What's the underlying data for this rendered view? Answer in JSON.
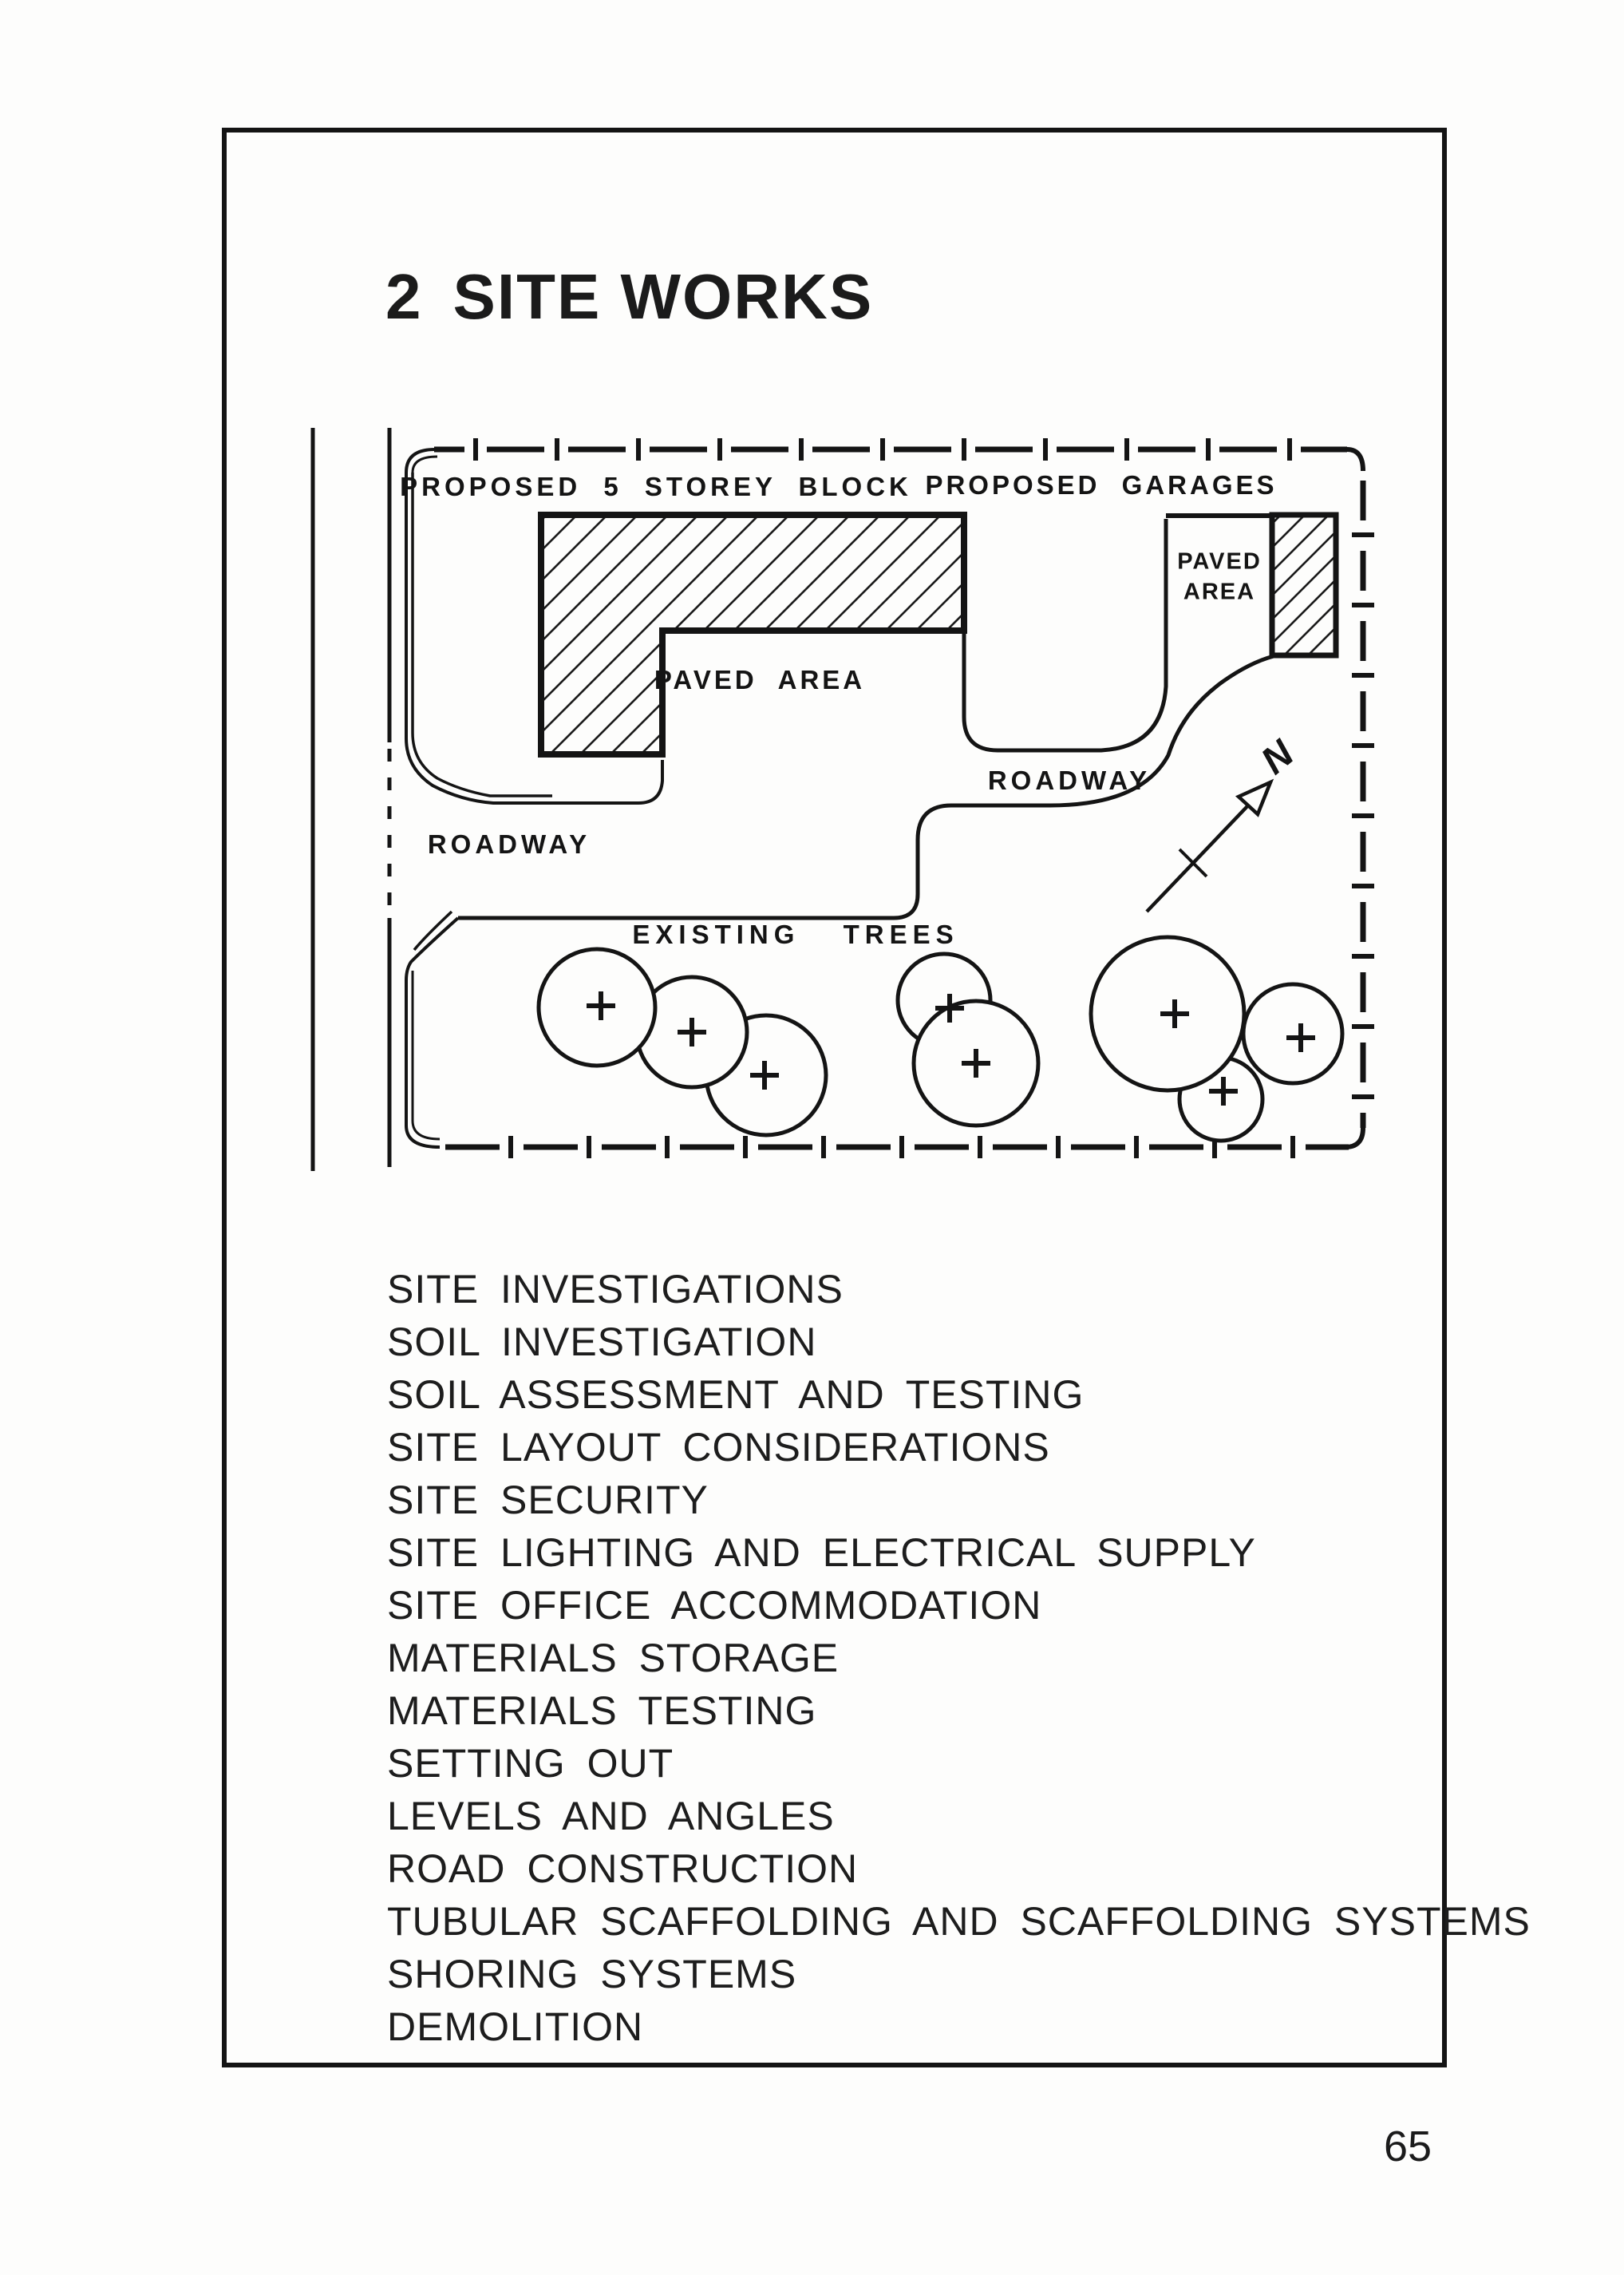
{
  "title": {
    "number": "2",
    "text": "SITE WORKS"
  },
  "page": {
    "number": "65"
  },
  "diagram": {
    "labels": {
      "proposed_block": "PROPOSED 5 STOREY BLOCK",
      "proposed_garages": "PROPOSED GARAGES",
      "paved_area_main": "PAVED AREA",
      "paved_area_court_1": "PAVED",
      "paved_area_court_2": "AREA",
      "roadway_left": "ROADWAY",
      "roadway_right": "ROADWAY",
      "existing_trees": "EXISTING TREES",
      "north": "N"
    }
  },
  "list": {
    "items": [
      "SITE INVESTIGATIONS",
      "SOIL INVESTIGATION",
      "SOIL ASSESSMENT AND TESTING",
      "SITE LAYOUT CONSIDERATIONS",
      "SITE SECURITY",
      "SITE LIGHTING AND ELECTRICAL SUPPLY",
      "SITE OFFICE ACCOMMODATION",
      "MATERIALS STORAGE",
      "MATERIALS TESTING",
      "SETTING OUT",
      "LEVELS AND ANGLES",
      "ROAD CONSTRUCTION",
      "TUBULAR SCAFFOLDING AND SCAFFOLDING SYSTEMS",
      "SHORING SYSTEMS",
      "DEMOLITION"
    ]
  }
}
